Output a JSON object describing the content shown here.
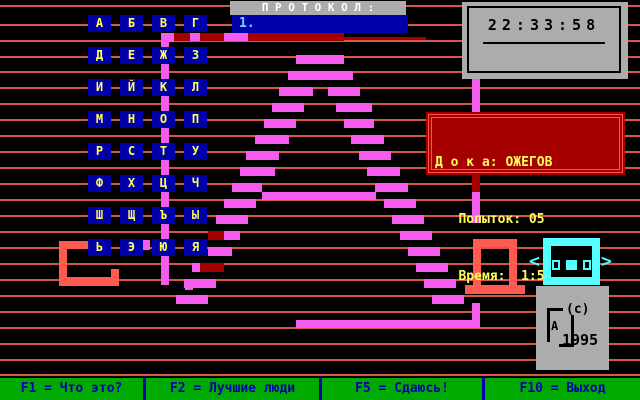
{
  "protocol": {
    "title": "П Р О Т О К О Л :",
    "first_entry": "1."
  },
  "clock": {
    "time": "22:33:58"
  },
  "status_panel": {
    "player_line": "Д о к а: ОЖЕГОВ",
    "attempts_line": "   Попыток: 05",
    "time_line": "   Время:  1:57"
  },
  "alphabet": {
    "rows": [
      [
        "А",
        "Б",
        "В",
        "Г"
      ],
      [
        "Д",
        "Е",
        "Ж",
        "З"
      ],
      [
        "И",
        "Й",
        "К",
        "Л"
      ],
      [
        "М",
        "Н",
        "О",
        "П"
      ],
      [
        "Р",
        "С",
        "Т",
        "У"
      ],
      [
        "Ф",
        "Х",
        "Ц",
        "Ч"
      ],
      [
        "Ш",
        "Щ",
        "Ъ",
        "Ы"
      ],
      [
        "Ь",
        "Э",
        "Ю",
        "Я"
      ]
    ]
  },
  "cursor": {
    "left_arrow": "<",
    "right_arrow": ">"
  },
  "copyright": {
    "c": "(c)",
    "year": "1995",
    "logo_letter": "А"
  },
  "function_bar": {
    "items": [
      {
        "label": "F1 = Что это?"
      },
      {
        "label": "F2 = Лучшие люди"
      },
      {
        "label": "F5 = Сдаюсь!"
      },
      {
        "label": "F10 = Выход"
      }
    ]
  },
  "colors": {
    "tile_bg": "#0000aa",
    "tile_text": "#ffff55",
    "bar_green": "#00aa00",
    "bar_text": "#0000aa",
    "panel_gray": "#acacac",
    "status_bg": "#a40000",
    "status_border": "#ff5548",
    "status_text": "#ffff55",
    "cyan": "#55ffff",
    "bg_line": "#d9544a",
    "entry_text": "#6fd6ff"
  },
  "art": {
    "colors": {
      "p": "#f45cf0",
      "r": "#a40000",
      "s": "#ff5a50"
    },
    "rects": [
      [
        168,
        33,
        176,
        8,
        "r"
      ],
      [
        344,
        37,
        82,
        3,
        "r"
      ],
      [
        208,
        231,
        16,
        9,
        "r"
      ],
      [
        200,
        263,
        24,
        9,
        "r"
      ],
      [
        472,
        175,
        8,
        17,
        "r"
      ],
      [
        59,
        241,
        31,
        8,
        "s"
      ],
      [
        59,
        241,
        8,
        45,
        "s"
      ],
      [
        59,
        277,
        60,
        9,
        "s"
      ],
      [
        111,
        269,
        8,
        17,
        "s"
      ],
      [
        473,
        239,
        44,
        8,
        "s"
      ],
      [
        473,
        239,
        8,
        46,
        "s"
      ],
      [
        509,
        239,
        8,
        46,
        "s"
      ],
      [
        465,
        285,
        60,
        9,
        "s"
      ],
      [
        161,
        33,
        13,
        9,
        "p"
      ],
      [
        161,
        33,
        8,
        252,
        "p"
      ],
      [
        190,
        33,
        10,
        8,
        "p"
      ],
      [
        224,
        33,
        24,
        8,
        "p"
      ],
      [
        472,
        78,
        8,
        35,
        "p"
      ],
      [
        472,
        192,
        8,
        31,
        "p"
      ],
      [
        139,
        240,
        11,
        10,
        "p"
      ],
      [
        185,
        240,
        8,
        10,
        "p"
      ],
      [
        185,
        280,
        8,
        10,
        "p"
      ],
      [
        296,
        55,
        48,
        9,
        "p"
      ],
      [
        288,
        71,
        65,
        9,
        "p"
      ],
      [
        279,
        87,
        34,
        9,
        "p"
      ],
      [
        328,
        87,
        32,
        9,
        "p"
      ],
      [
        272,
        103,
        32,
        9,
        "p"
      ],
      [
        336,
        103,
        36,
        9,
        "p"
      ],
      [
        264,
        119,
        32,
        9,
        "p"
      ],
      [
        344,
        119,
        30,
        9,
        "p"
      ],
      [
        255,
        135,
        34,
        9,
        "p"
      ],
      [
        351,
        135,
        33,
        9,
        "p"
      ],
      [
        246,
        151,
        33,
        9,
        "p"
      ],
      [
        359,
        151,
        32,
        9,
        "p"
      ],
      [
        240,
        167,
        35,
        9,
        "p"
      ],
      [
        367,
        167,
        33,
        9,
        "p"
      ],
      [
        232,
        183,
        30,
        9,
        "p"
      ],
      [
        375,
        183,
        33,
        9,
        "p"
      ],
      [
        262,
        192,
        114,
        8,
        "p"
      ],
      [
        224,
        199,
        32,
        9,
        "p"
      ],
      [
        384,
        199,
        32,
        9,
        "p"
      ],
      [
        216,
        215,
        32,
        9,
        "p"
      ],
      [
        392,
        215,
        32,
        9,
        "p"
      ],
      [
        224,
        231,
        16,
        9,
        "p"
      ],
      [
        400,
        231,
        32,
        9,
        "p"
      ],
      [
        208,
        247,
        24,
        9,
        "p"
      ],
      [
        408,
        247,
        32,
        9,
        "p"
      ],
      [
        192,
        263,
        8,
        9,
        "p"
      ],
      [
        416,
        263,
        32,
        9,
        "p"
      ],
      [
        184,
        279,
        32,
        9,
        "p"
      ],
      [
        424,
        279,
        32,
        9,
        "p"
      ],
      [
        176,
        295,
        32,
        9,
        "p"
      ],
      [
        432,
        295,
        32,
        9,
        "p"
      ],
      [
        296,
        320,
        184,
        8,
        "p"
      ],
      [
        472,
        303,
        8,
        18,
        "p"
      ]
    ]
  },
  "background": {
    "line_ys": [
      5,
      24,
      40,
      56,
      71,
      87,
      103,
      119,
      135,
      151,
      167,
      183,
      199,
      215,
      231,
      247,
      263,
      279,
      295,
      311,
      327,
      343,
      359,
      374
    ]
  }
}
